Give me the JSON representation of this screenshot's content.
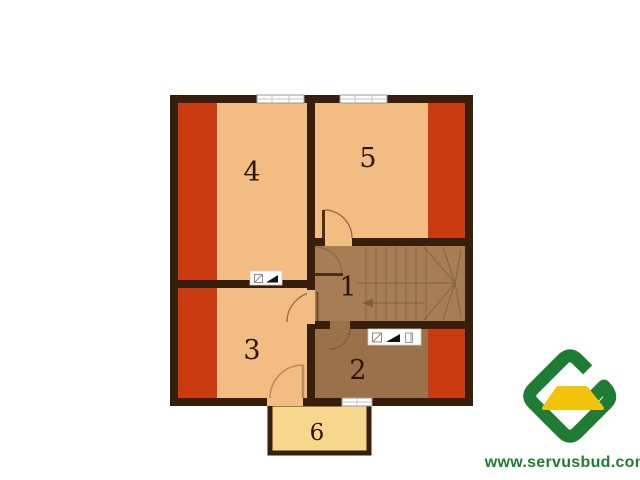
{
  "plan": {
    "title": "floor-plan-upper-storey",
    "room_labels": {
      "hall": "1",
      "bathroom": "2",
      "bedroom3": "3",
      "bedroom4": "4",
      "bedroom5": "5",
      "balcony": "6"
    },
    "colors": {
      "wall": "#371e0d",
      "room_floor": "#f2bc82",
      "sloped_ceiling": "#ca3a10",
      "hall_floor": "#a67d55",
      "bathroom_floor": "#9b7149",
      "balcony_floor": "#f7d78c",
      "stair_line": "#6e4e30",
      "window_frame": "#999999"
    },
    "symbol_plates": [
      {
        "location": "wall-room4-room3",
        "icons": [
          "vent-duct-icon",
          "chimney-flue-icon"
        ]
      },
      {
        "location": "wall-hall-bathroom",
        "icons": [
          "vent-duct-icon",
          "chimney-flue-icon",
          "duct-icon"
        ]
      }
    ],
    "features": {
      "windows_top": 2,
      "windows_bottom": 1,
      "stair": "winder-staircase-with-direction-arrow"
    }
  },
  "logo": {
    "text": "www.servusbud.com",
    "green": "#1f7d33",
    "yellow": "#f1c40b"
  }
}
